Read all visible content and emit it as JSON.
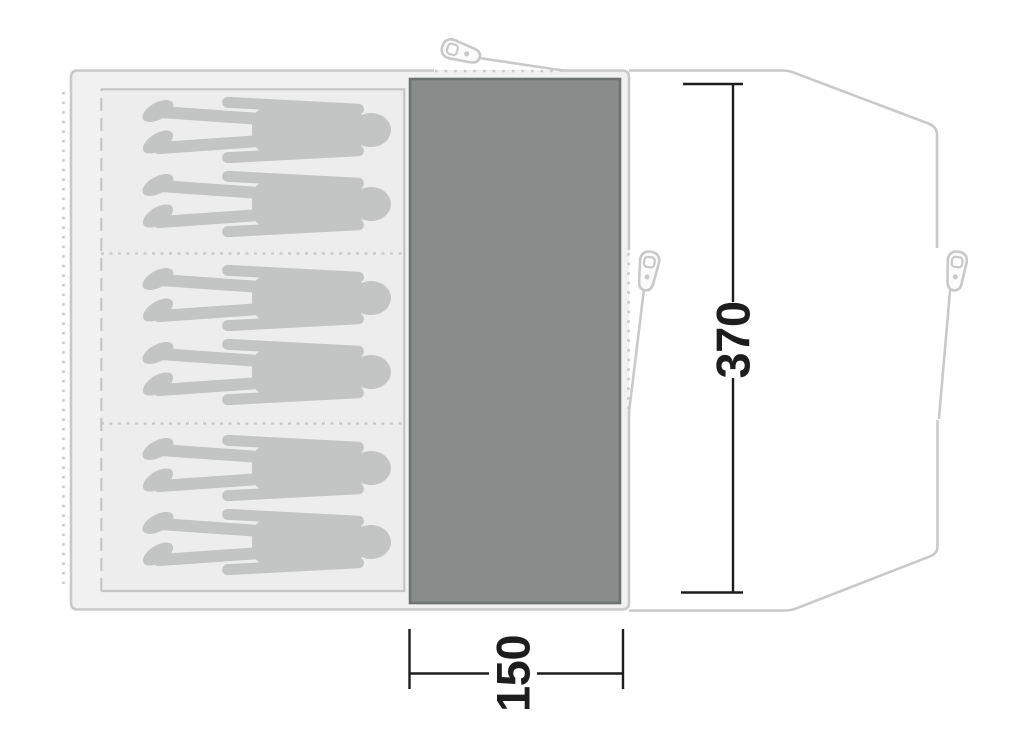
{
  "diagram": {
    "type": "tent-floorplan-top-view",
    "dimensions": {
      "depth_cm": "370",
      "width_cm": "150"
    },
    "sleeping_area": {
      "compartments": 3,
      "persons_per_compartment": 2,
      "total_persons": 6
    },
    "icons": {
      "peg_icon": "tent-peg-icon",
      "peg_count": 3,
      "person_icon": "person-silhouette"
    },
    "colors": {
      "outline": "#c9c9c9",
      "inner_line": "#c6c6c6",
      "body_fill": "#f1f1f1",
      "sleeping_fill": "#ededed",
      "silhouette": "#c2c5c4",
      "groundsheet_fill": "#888c8b",
      "groundsheet_border": "#6e7271",
      "dimension": "#1d1d1d"
    }
  }
}
